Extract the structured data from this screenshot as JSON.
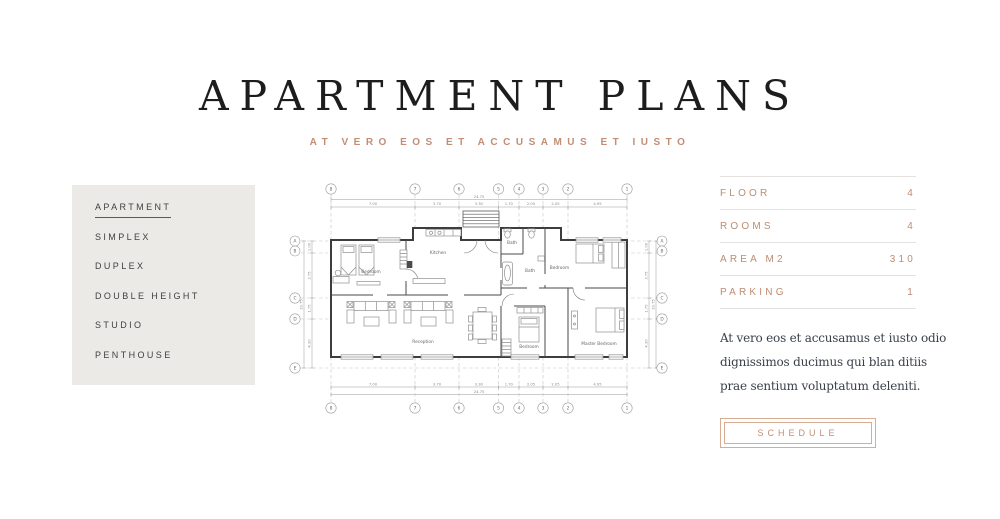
{
  "header": {
    "title": "APARTMENT PLANS",
    "subtitle": "AT VERO EOS ET ACCUSAMUS ET IUSTO"
  },
  "sidebar": {
    "items": [
      {
        "label": "APARTMENT",
        "active": true
      },
      {
        "label": "SIMPLEX",
        "active": false
      },
      {
        "label": "DUPLEX",
        "active": false
      },
      {
        "label": "DOUBLE HEIGHT",
        "active": false
      },
      {
        "label": "STUDIO",
        "active": false
      },
      {
        "label": "PENTHOUSE",
        "active": false
      }
    ]
  },
  "plan": {
    "grid_cols": [
      "8",
      "7",
      "6",
      "5",
      "4",
      "3",
      "2",
      "1"
    ],
    "grid_rows": [
      "A",
      "B",
      "C",
      "D",
      "E"
    ],
    "dims_h": [
      "7.00",
      "3.70",
      "3.30",
      "1.70",
      "2.05",
      "2.05",
      "4.95"
    ],
    "total_w": "24.75",
    "dims_v": [
      "1.00",
      "3.75",
      "1.75",
      "4.30"
    ],
    "total_h": "10.75",
    "rooms": {
      "bedroom_top": "Bedroom",
      "kitchen": "Kitchen",
      "bath_small": "Bath",
      "bath_large": "Bath",
      "bedroom_right": "Bedroom",
      "reception": "Reception",
      "bedroom_bottom": "Bedroom",
      "master_bedroom": "Master Bedroom"
    }
  },
  "details": {
    "rows": [
      {
        "label": "FLOOR",
        "value": "4"
      },
      {
        "label": "ROOMS",
        "value": "4"
      },
      {
        "label": "AREA M2",
        "value": "310"
      },
      {
        "label": "PARKING",
        "value": "1"
      }
    ],
    "description_lines": [
      "At vero eos et accusamus et iusto odio",
      "dignissimos ducimus qui blan ditiis",
      "prae sentium voluptatum deleniti."
    ],
    "button_label": "SCHEDULE"
  },
  "colors": {
    "accent": "#bd8d72",
    "sidebar_bg": "#ebeae7",
    "title_color": "#1d1d1d",
    "divider": "#e4e1de"
  }
}
